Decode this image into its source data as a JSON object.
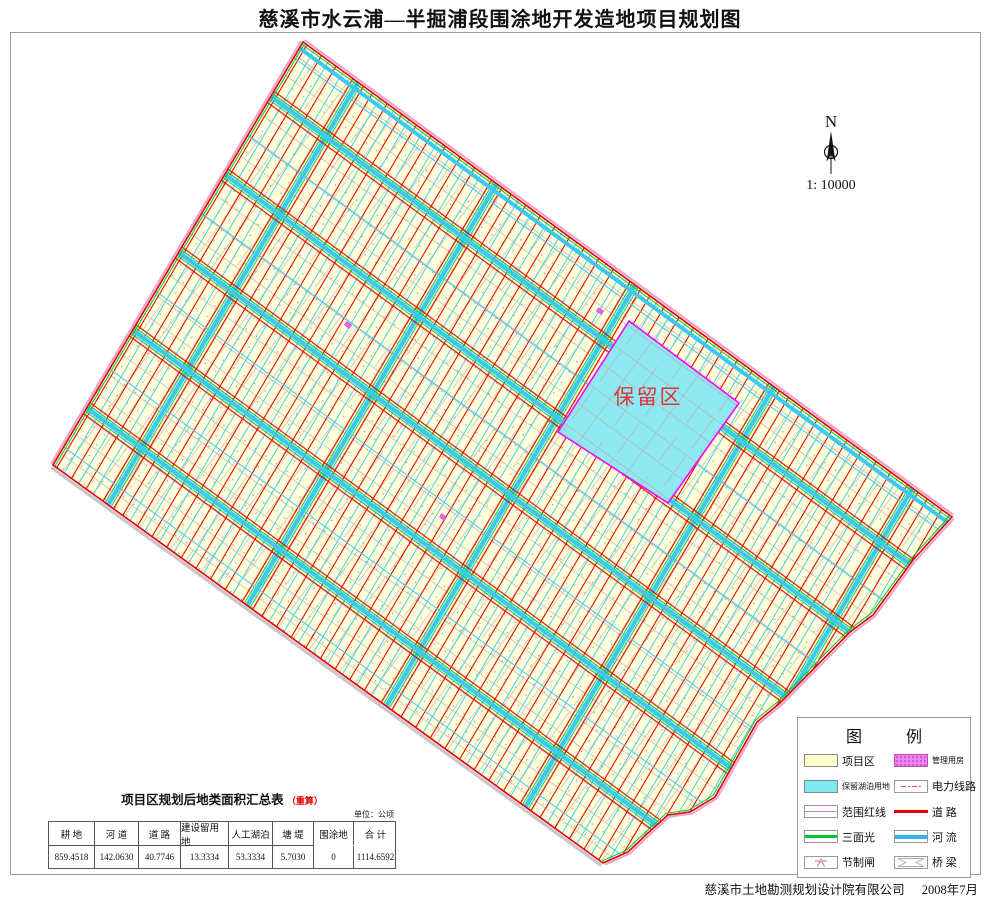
{
  "page": {
    "title": "慈溪市水云浦—半掘浦段围涂地开发造地项目规划图"
  },
  "north_arrow": {
    "label": "N",
    "scale": "1: 10000"
  },
  "map": {
    "reserved_area_label": "保留区"
  },
  "legend": {
    "title_left": "图",
    "title_right": "例",
    "left_items": [
      {
        "label": "项目区"
      },
      {
        "label": "保留湖泊用地"
      },
      {
        "label": "范围红线"
      },
      {
        "label": "三面光"
      },
      {
        "label": "节制闸"
      }
    ],
    "right_items": [
      {
        "label": "管理用房"
      },
      {
        "label": "电力线路"
      },
      {
        "label": "道 路"
      },
      {
        "label": "河 流"
      },
      {
        "label": "桥 梁"
      }
    ]
  },
  "table": {
    "title": "项目区规划后地类面积汇总表",
    "note": "（重算）",
    "unit": "单位：公顷",
    "headers": [
      "耕  地",
      "河  道",
      "道  路",
      "建设留用地",
      "人工湖泊",
      "塘  堤",
      "围涂地",
      "合  计"
    ],
    "values": [
      "859.4518",
      "142.0630",
      "40.7746",
      "13.3334",
      "53.3334",
      "5.7030",
      "0",
      "1114.6592"
    ]
  },
  "footer": {
    "credit": "慈溪市土地勘测规划设计院有限公司",
    "date": "2008年7月"
  },
  "colors": {
    "project_area_fill": "#FFFFDC",
    "road_red": "#E60000",
    "river_cyan": "#3CC8F0",
    "green_channel": "#00C832",
    "reserved_fill": "#8FE9F2",
    "range_redline_magenta": "#FF00FF",
    "boundary_pink": "#F2A0CC",
    "management_pink": "#EE82EE",
    "parcel_gray": "#B0B0B0"
  }
}
